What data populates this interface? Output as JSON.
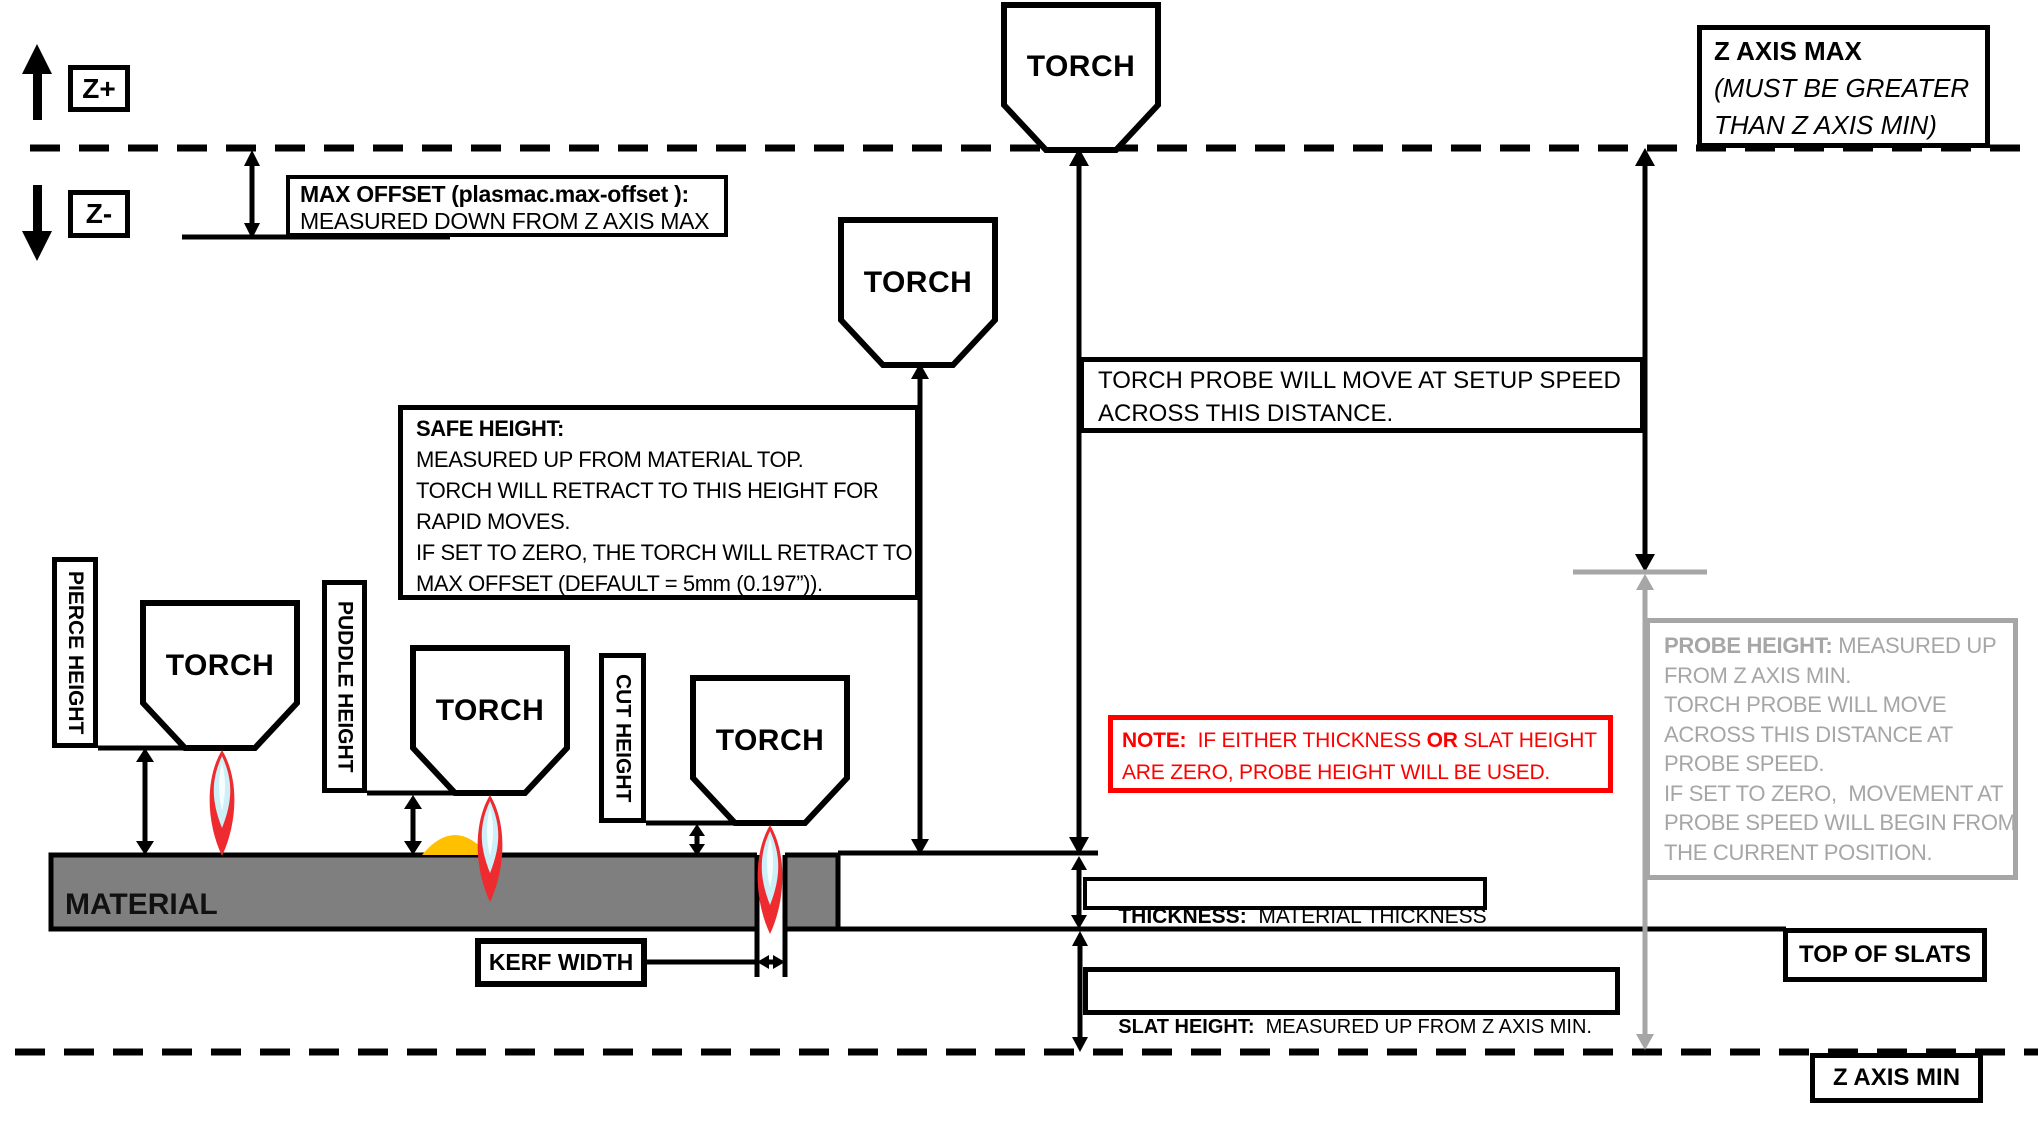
{
  "colors": {
    "line_black": "#000000",
    "note_red": "#FF0000",
    "material_gray": "#7F7F7F",
    "muted_gray": "#A6A6A6",
    "puddle_orange": "#FFC000",
    "flame_red": "#EE2B2E",
    "flame_cyan": "#CDEFF7"
  },
  "axis_labels": {
    "z_plus": "Z+",
    "z_minus": "Z-"
  },
  "z_axis_max_box": {
    "title": "Z AXIS MAX",
    "note_line1": "(MUST BE GREATER",
    "note_line2": "THAN Z AXIS MIN)"
  },
  "z_axis_min_box": {
    "label": "Z AXIS MIN"
  },
  "max_offset_box": {
    "line1": "MAX OFFSET (plasmac.max-offset ):",
    "line2": "MEASURED DOWN FROM Z AXIS MAX"
  },
  "setup_speed_box": {
    "line1": "TORCH PROBE WILL MOVE AT SETUP SPEED",
    "line2": "ACROSS THIS DISTANCE."
  },
  "safe_height_box": {
    "title": "SAFE HEIGHT:",
    "lines": [
      "MEASURED UP FROM MATERIAL TOP.",
      "TORCH WILL RETRACT TO THIS HEIGHT FOR",
      "RAPID MOVES.",
      "IF SET TO ZERO, THE TORCH WILL RETRACT TO",
      "MAX OFFSET (DEFAULT = 5mm (0.197”))."
    ]
  },
  "note_box": {
    "bold1": "NOTE:",
    "seg1": "  IF EITHER THICKNESS ",
    "bold2": "OR",
    "seg2": " SLAT HEIGHT",
    "line2": "ARE ZERO, PROBE HEIGHT WILL BE USED."
  },
  "thickness_box": {
    "title": "THICKNESS:",
    "text": "  MATERIAL THICKNESS"
  },
  "slat_height_box": {
    "title": "SLAT HEIGHT:",
    "text": "  MEASURED UP FROM Z AXIS MIN."
  },
  "probe_height_box": {
    "title": "PROBE HEIGHT:",
    "lines": [
      " MEASURED UP",
      "FROM Z AXIS MIN.",
      "TORCH PROBE WILL MOVE",
      "ACROSS THIS DISTANCE AT",
      "PROBE SPEED.",
      "IF SET TO ZERO,  MOVEMENT AT",
      "PROBE SPEED WILL BEGIN FROM",
      "THE CURRENT POSITION."
    ]
  },
  "height_labels": {
    "pierce": "PIERCE HEIGHT",
    "puddle": "PUDDLE HEIGHT",
    "cut": "CUT HEIGHT"
  },
  "torch_label": "TORCH",
  "material_label": "MATERIAL",
  "kerf_width_box": {
    "label": "KERF WIDTH"
  },
  "top_of_slats_box": {
    "label": "TOP OF SLATS"
  }
}
